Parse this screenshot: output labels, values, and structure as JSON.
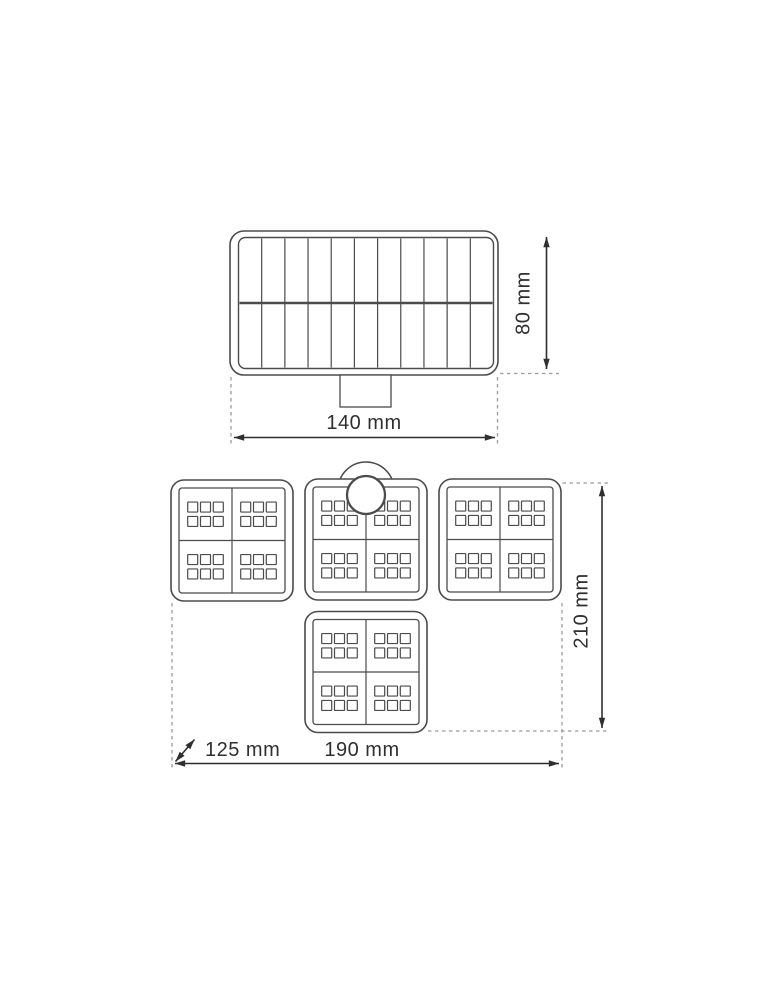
{
  "page": {
    "background": "#ffffff",
    "description": "Dimensional line drawing of a solar LED floodlight: solar panel front view (top) and four-module LED head view (bottom)"
  },
  "drawing": {
    "colors": {
      "outline": "#4b4b4b",
      "dimension": "#2f2f2f",
      "dashed": "#9a9a9a",
      "background": "#ffffff"
    },
    "front_view": {
      "name": "solar-panel-front-view",
      "solar_cell_columns": 11,
      "solar_cell_rows": 2,
      "has_mounting_bracket": true
    },
    "head_view": {
      "name": "led-head-top-view",
      "panel_count": 4,
      "quadrants_per_panel": 4,
      "led_columns_per_quadrant": 3,
      "led_rows_per_quadrant": 2,
      "has_motion_sensor": true
    },
    "labels": {
      "front_width": "140 mm",
      "front_height": "80 mm",
      "head_width": "190 mm",
      "head_height": "210 mm",
      "head_depth": "125 mm"
    }
  }
}
